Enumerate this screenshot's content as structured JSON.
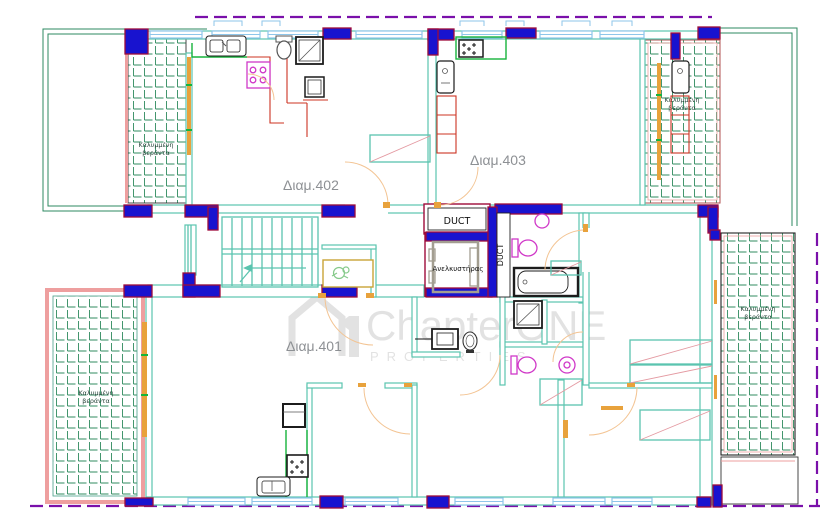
{
  "labels": {
    "apartment_401": "Διαμ.401",
    "apartment_402": "Διαμ.402",
    "apartment_403": "Διαμ.403",
    "veranda_line1": "Καλυμμένη",
    "veranda_line2": "βεράντα",
    "duct_top": "DUCT",
    "duct_side": "DUCT",
    "elevator": "Ανελκυστήρας"
  },
  "watermark": {
    "brand": "ChapterONE",
    "tagline": "PROPERTIES"
  },
  "colors": {
    "column_fill": "#1813cf",
    "column_stroke": "#9e0b3a",
    "wall": "#5bc4af",
    "window": "#8ec6ea",
    "boundary_purple": "#7a10aa",
    "boundary_green": "#2c8a60",
    "hatch_green": "#2f8b5f",
    "counter_red": "#cc3322",
    "fixture_magenta": "#d038c8",
    "door_orange": "#e8a23c",
    "door_arc": "#f3c493",
    "pink_border": "#ee9f9f",
    "pink_diagonal": "#e49aa2",
    "label_gray": "#8d9094",
    "veranda_label": "#27453a",
    "watermark_gray": "#dcdcdc",
    "bright_green": "#17b33c",
    "landing_yellow": "#c9a437",
    "plant_green": "#86c98a",
    "elevator_gray": "#a39e91",
    "fixture_dark": "#1c1c1c"
  }
}
